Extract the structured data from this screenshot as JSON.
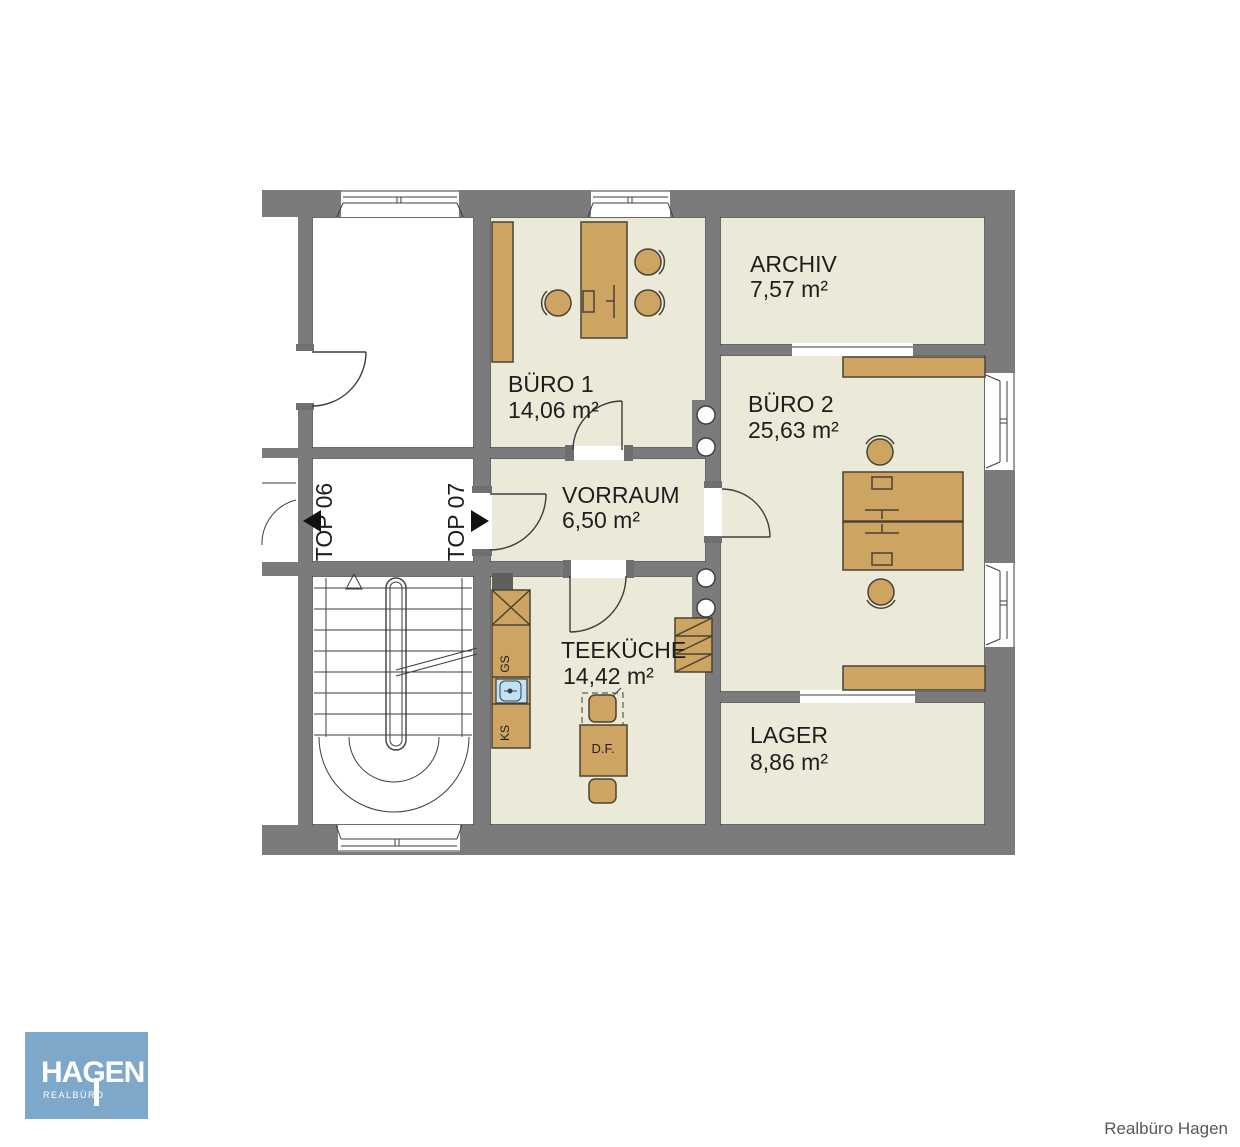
{
  "plan": {
    "title_hint": "floor plan of office unit TOP 07",
    "rooms": [
      {
        "id": "archiv",
        "label": "ARCHIV",
        "area": "7,57 m²"
      },
      {
        "id": "buero1",
        "label": "BÜRO 1",
        "area": "14,06 m²"
      },
      {
        "id": "buero2",
        "label": "BÜRO 2",
        "area": "25,63 m²"
      },
      {
        "id": "vorraum",
        "label": "VORRAUM",
        "area": "6,50 m²"
      },
      {
        "id": "teekueche",
        "label": "TEEKÜCHE",
        "area": "14,42 m²"
      },
      {
        "id": "lager",
        "label": "LAGER",
        "area": "8,86 m²"
      }
    ],
    "units": [
      {
        "label": "TOP 06",
        "arrow": "left"
      },
      {
        "label": "TOP 07",
        "arrow": "right"
      }
    ],
    "fixture_labels": {
      "gs": "GS",
      "ks": "KS",
      "df": "D.F."
    },
    "colors": {
      "wall": "#7b7b7b",
      "room": "#ebe9d8",
      "line": "#3d3d3d",
      "furniture": "#cda462",
      "furniture-outline": "#4a4335",
      "sink": "#bfe2f5",
      "logo-bg": "#7ea8c9",
      "text": "#1e1e1e",
      "credit": "#585858"
    }
  },
  "logo": {
    "name": "HAGEN",
    "subtitle": "REALBÜRO"
  },
  "footer": {
    "credit": "Realbüro Hagen"
  }
}
